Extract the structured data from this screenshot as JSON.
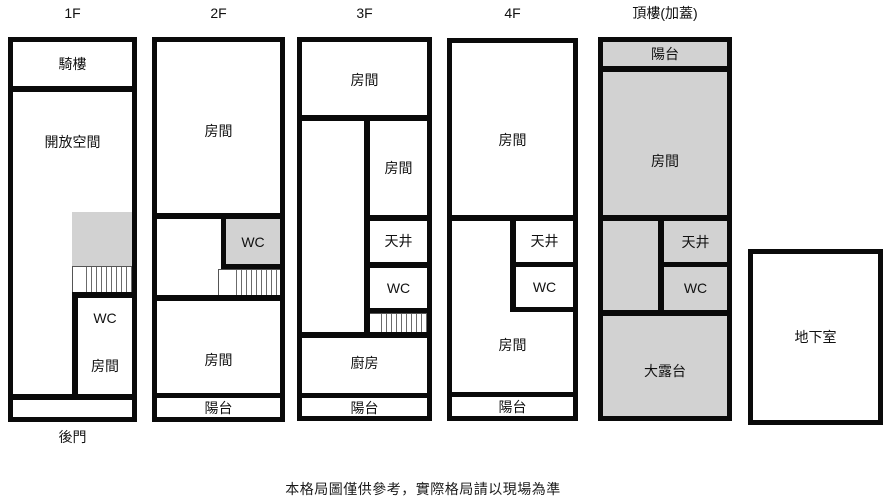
{
  "page": {
    "disclaimer": "本格局圖僅供參考，實際格局請以現場為準"
  },
  "floors": {
    "f1": {
      "label": "1F",
      "arcade": "騎樓",
      "open_space": "開放空間",
      "wc": "WC",
      "room": "房間",
      "back_door": "後門"
    },
    "f2": {
      "label": "2F",
      "room_top": "房間",
      "wc": "WC",
      "room_bottom": "房間",
      "balcony": "陽台"
    },
    "f3": {
      "label": "3F",
      "room_top": "房間",
      "room_right": "房間",
      "lightwell": "天井",
      "wc": "WC",
      "kitchen": "廚房",
      "balcony": "陽台"
    },
    "f4": {
      "label": "4F",
      "room_top": "房間",
      "lightwell": "天井",
      "wc": "WC",
      "room_bottom": "房間",
      "balcony": "陽台"
    },
    "roof": {
      "label": "頂樓(加蓋)",
      "balcony": "陽台",
      "room": "房間",
      "lightwell": "天井",
      "wc": "WC",
      "terrace": "大露台"
    },
    "basement": {
      "label": "地下室"
    }
  },
  "colors": {
    "wall": "#0a0a0a",
    "shaded_fill": "#d2d2d2",
    "room_fill": "#ffffff",
    "background": "#ffffff"
  }
}
